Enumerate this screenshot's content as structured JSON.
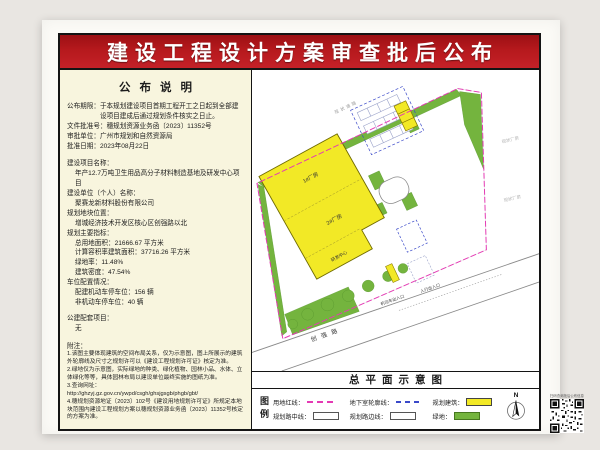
{
  "banner": {
    "title": "建设工程设计方案审查批后公布"
  },
  "notice_panel": {
    "heading": "公布说明",
    "rows": [
      {
        "cls": "hang",
        "label": "公布期限：",
        "value": "于本规划建设项目首期工程开工之日起到全部建设项目建成后通过规划条件核实之日止。"
      },
      {
        "cls": "hang",
        "label": "文件批准号：",
        "value": "穗规划资源业务函〔2023〕11352号"
      },
      {
        "cls": "hang",
        "label": "审批单位：",
        "value": "广州市规划和自然资源局"
      },
      {
        "cls": "hang",
        "label": "批准日期：",
        "value": "2023年08月22日"
      },
      {
        "cls": "mt8",
        "label": "建设项目名称："
      },
      {
        "cls": "ind",
        "value": "年产12.7万吨卫生用品高分子材料制造基地及研发中心项目"
      },
      {
        "label": "建设单位（个人）名称："
      },
      {
        "cls": "ind",
        "value": "聚赛龙新材料股份有限公司"
      },
      {
        "label": "规划地块位置："
      },
      {
        "cls": "ind",
        "value": "增城经济技术开发区核心区创强路以北"
      },
      {
        "label": "规划主要指标："
      },
      {
        "cls": "ind",
        "label": "总用地面积：",
        "value": "21666.67 平方米"
      },
      {
        "cls": "ind",
        "label": "计算容积率建筑面积：",
        "value": "37716.26 平方米"
      },
      {
        "cls": "ind",
        "label": "绿地率：",
        "value": "11.48%"
      },
      {
        "cls": "ind",
        "label": "建筑密度：",
        "value": "47.54%"
      },
      {
        "label": "车位配置情况："
      },
      {
        "cls": "ind",
        "label": "配建机动车停车位：",
        "value": "156 辆"
      },
      {
        "cls": "ind",
        "label": "非机动车停车位：",
        "value": "40 辆"
      },
      {
        "cls": "mt6",
        "label": "公建配套项目："
      },
      {
        "cls": "ind",
        "value": "无"
      },
      {
        "cls": "mt8",
        "label": "附注："
      },
      {
        "cls": "note",
        "value": "1.该图主要体现建筑的空间布局关系，仅为示意图，图上所展示的建筑外轮廓线及尺寸之规划许可以《建设工程规划许可证》核定为准。"
      },
      {
        "cls": "note",
        "value": "2.绿地仅为示意图，实际绿地的种类、绿化植物、园林小品、水体、立体绿化等等，具体园林布局以建设单位最终实施的图纸为准。"
      },
      {
        "cls": "note",
        "value": "3.查询网址："
      },
      {
        "cls": "note url",
        "value": "http://ghzyj.gz.gov.cn/ywpd/csgh/ghsjgsgb/phgb/gbt/"
      },
      {
        "cls": "note",
        "value": "4.穗规划资源地证〔2023〕102号《建设用地规划许可证》所规定本地块范围内建设工程规划方案以穗规划资源业务函〔2023〕11352号核定的方案为准。"
      }
    ]
  },
  "site_plan": {
    "title": "总平面示意图",
    "road_name": "创强路",
    "north_label": "N",
    "labels": {
      "building1": "1#厂房",
      "building2": "2#厂房",
      "building3": "研发中心",
      "existing_road": "现状道路",
      "existing_factory_1": "现状厂房",
      "existing_factory_2": "现状厂房",
      "vehicle_entrance": "机动车出入口",
      "pedestrian_entrance": "人行出入口"
    }
  },
  "legend": {
    "heading": "图例",
    "items": [
      {
        "label": "用地红线：",
        "swatch": "redline"
      },
      {
        "label": "地下室轮廓线：",
        "swatch": "basement"
      },
      {
        "label": "规划建筑：",
        "swatch": "building"
      },
      {
        "label": "规划路中线：",
        "swatch": "road_center"
      },
      {
        "label": "规划路边线：",
        "swatch": "road_edge"
      },
      {
        "label": "绿地：",
        "swatch": "green"
      }
    ]
  },
  "qr": {
    "caption": "扫码查询批后公布信息"
  },
  "colors": {
    "banner_red": "#b6191d",
    "building_yellow": "#f2e926",
    "landscape_green": "#74b43e",
    "redline_magenta": "#e43bb4",
    "basement_blue": "#3a49c9",
    "paper": "#fbfaf6",
    "panel_cream": "#f8f5de"
  }
}
